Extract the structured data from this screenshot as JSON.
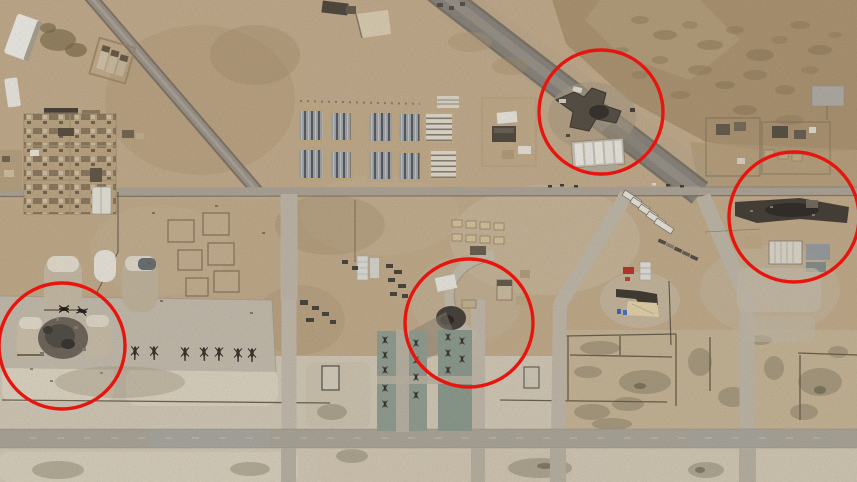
{
  "image": {
    "kind": "satellite-photograph",
    "subject": "desert airbase aerial view with circled damage sites",
    "width_px": 857,
    "height_px": 482
  },
  "palette": {
    "sand": "#c8b190",
    "sand_light": "#d9cfbc",
    "sand_pale": "#e5dcc9",
    "rock": "#b29a77",
    "road_gray": "#8f8a82",
    "taxiway_gray": "#b2ac9f",
    "helipad_green": "#98a497",
    "building_dark": "#5c544a",
    "building_white": "#f3f1ea",
    "debris_gray": "#746b60",
    "annotation_red": "#e8150f"
  },
  "annotations": {
    "shape": "circle",
    "color": "#e8150f",
    "stroke_width": 3.4,
    "circles": [
      {
        "id": "annotation-circle-northeast",
        "cx": 601,
        "cy": 112,
        "r": 62
      },
      {
        "id": "annotation-circle-east",
        "cx": 794,
        "cy": 217,
        "r": 65
      },
      {
        "id": "annotation-circle-center",
        "cx": 469,
        "cy": 323,
        "r": 64
      },
      {
        "id": "annotation-circle-southwest",
        "cx": 62,
        "cy": 346,
        "r": 63
      }
    ]
  },
  "scene": {
    "features": [
      "barracks-grid-complex",
      "walled-compounds",
      "quonset-hangars",
      "destroyed-aircraft-shelters",
      "burned-building-clusters",
      "tent-camp",
      "green-helipads",
      "parked-helicopter-row",
      "taxiways-and-roads",
      "rocky-desert-terrain",
      "agricultural-plots"
    ],
    "parked_helicopters_count": 7,
    "helipad_aircraft_count": 14
  }
}
